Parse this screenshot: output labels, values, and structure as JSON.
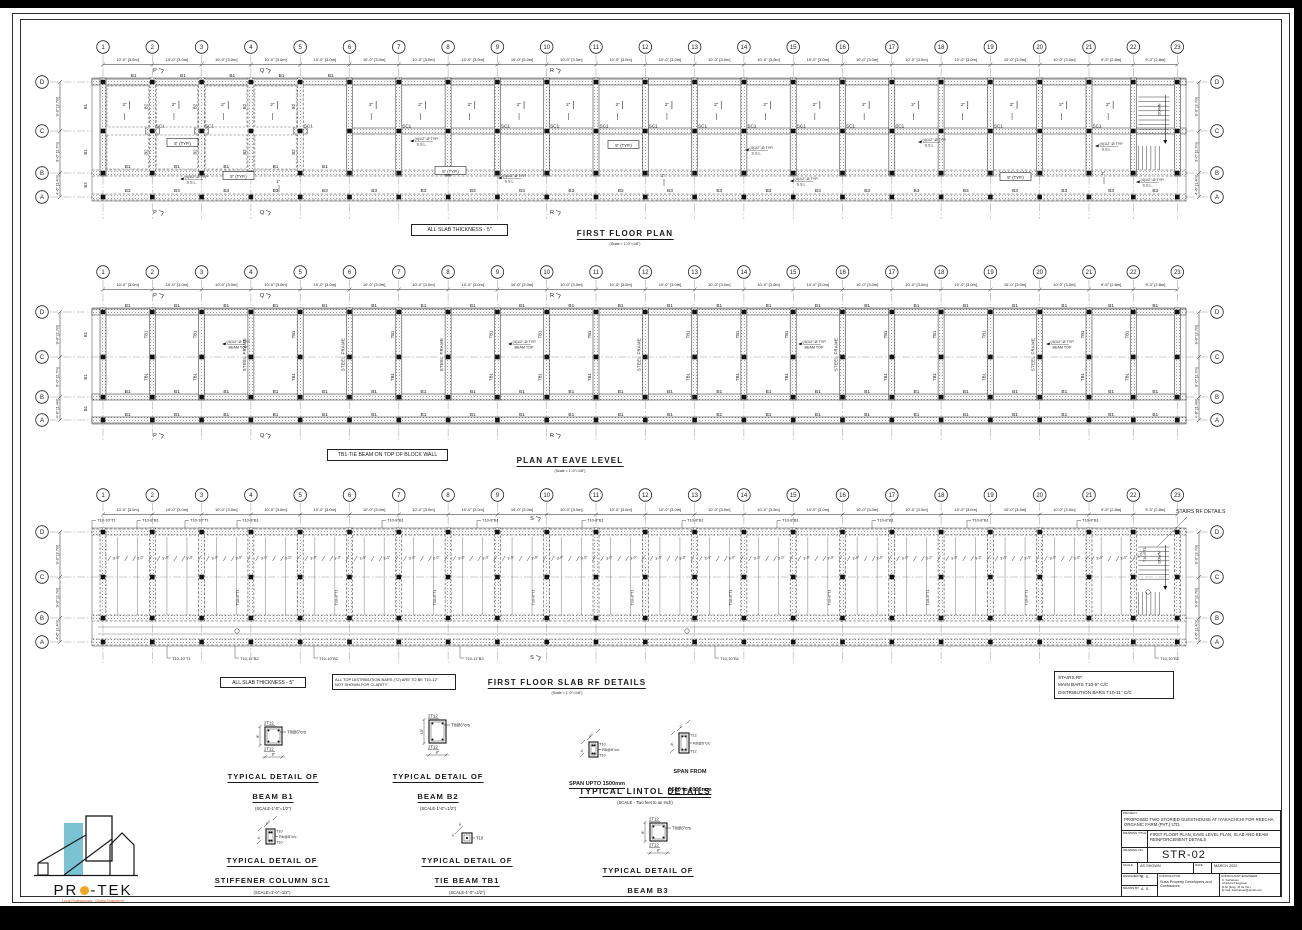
{
  "grid": {
    "numbers": [
      "1",
      "2",
      "3",
      "4",
      "5",
      "6",
      "7",
      "8",
      "9",
      "10",
      "11",
      "12",
      "13",
      "14",
      "15",
      "16",
      "17",
      "18",
      "19",
      "20",
      "21",
      "22",
      "23"
    ],
    "span_dims": [
      "10'-0\" [3.0m]",
      "10'-0\" [3.0m]",
      "10'-0\" [3.0m]",
      "10'-0\" [3.0m]",
      "10'-0\" [3.0m]",
      "10'-0\" [3.0m]",
      "10'-0\" [3.0m]",
      "10'-0\" [3.0m]",
      "10'-0\" [3.0m]",
      "10'-0\" [3.0m]",
      "10'-0\" [3.0m]",
      "10'-0\" [3.0m]",
      "10'-0\" [3.0m]",
      "10'-0\" [3.0m]",
      "10'-0\" [3.0m]",
      "10'-0\" [3.0m]",
      "10'-0\" [3.0m]",
      "10'-0\" [3.0m]",
      "10'-0\" [3.0m]",
      "10'-0\" [3.0m]",
      "9'-5\" [2.8m]",
      "9'-3\" [2.8m]"
    ],
    "rows": [
      "D",
      "C",
      "B",
      "A"
    ],
    "row_dims": [
      "9'-0\" [2.7m]",
      "9'-0\" [2.7m]",
      "4'-6\" [1.4m]"
    ]
  },
  "plan1": {
    "title": "FIRST FLOOR PLAN",
    "scale": "(Scale = 1'-0\"=1/8\")",
    "note": "ALL SLAB THICKNESS - 5\"",
    "beam": "B1",
    "beam_b2": "B2",
    "beam_bottom": "B3",
    "sc1": "SC1",
    "two": "2\"",
    "typ": "5\" (TYP.)",
    "typ_points": [
      [
        167,
        144
      ],
      [
        223,
        177
      ],
      [
        435,
        172
      ],
      [
        608,
        146
      ],
      [
        1000,
        178
      ]
    ],
    "ssl": [
      "(4)1/2\"-Ø TYP.",
      "S.S.L."
    ],
    "ssl_points": [
      [
        180,
        177
      ],
      [
        410,
        139
      ],
      [
        498,
        176
      ],
      [
        745,
        148
      ],
      [
        790,
        179
      ],
      [
        918,
        140
      ],
      [
        1095,
        144
      ],
      [
        1136,
        180
      ]
    ],
    "one": "1\"",
    "one_points": [
      [
        278,
        183
      ],
      [
        663,
        177
      ],
      [
        1103,
        175
      ]
    ],
    "sections": [
      {
        "label": "P",
        "x": 155
      },
      {
        "label": "Q",
        "x": 262
      },
      {
        "label": "R",
        "x": 552
      }
    ],
    "top_spans": [
      0,
      1,
      2,
      3,
      4
    ],
    "sc1_grids": [
      2,
      3,
      5,
      7,
      9,
      10,
      11,
      12,
      13,
      14,
      15,
      16,
      17,
      19,
      21
    ]
  },
  "plan2": {
    "title": "PLAN AT EAVE LEVEL",
    "scale": "(Scale = 1'-0\"=1/8\")",
    "note": "TB1-TIE BEAM ON TOP OF BLOCK WALL",
    "beam": "B1",
    "tb1": "TB1",
    "steel": "STEEL FRAME",
    "note_arrow": [
      "(4)1/2\"-Ø TYP.",
      "BEAM TOP"
    ],
    "note_points": [
      [
        222,
        342
      ],
      [
        508,
        342
      ],
      [
        798,
        342
      ],
      [
        1046,
        342
      ]
    ],
    "tb1_grids": [
      2,
      3,
      5,
      7,
      9,
      10,
      11,
      13,
      14,
      15,
      17,
      18,
      19,
      21,
      22
    ],
    "steel_grids": [
      4,
      6,
      8,
      12,
      16,
      20
    ]
  },
  "plan3": {
    "title": "FIRST FLOOR SLAB RF DETAILS",
    "scale": "(Scale = 1'-0\"=1/8\")",
    "note1": "ALL SLAB THICKNESS - 5\"",
    "note2a": "ALL TOP DISTRIBUTION BARS (T2) ARE TO BE T10-12\"",
    "note2b": "NOT SHOWN FOR CLARITY",
    "stairs_rf": [
      "STAIRS RF:",
      "MAIN BARS   T10-5\" C/C",
      "DISTRIBUTION BARS   T10-11\" C/C"
    ],
    "stairs_label": "STAIRS RF DETAILS",
    "top_callouts": [
      {
        "x": 95,
        "t": "T10-10\"T1"
      },
      {
        "x": 140,
        "t": "T10-8\"B1"
      },
      {
        "x": 188,
        "t": "T10-10\"T1"
      },
      {
        "x": 240,
        "t": "T10-8\"B1"
      },
      {
        "x": 385,
        "t": "T10-8\"B1"
      },
      {
        "x": 480,
        "t": "T10-8\"B1"
      },
      {
        "x": 585,
        "t": "T10-8\"B1"
      },
      {
        "x": 685,
        "t": "T10-8\"B1"
      },
      {
        "x": 780,
        "t": "T10-8\"B1"
      },
      {
        "x": 875,
        "t": "T10-8\"B1"
      },
      {
        "x": 970,
        "t": "T10-8\"B1"
      },
      {
        "x": 1080,
        "t": "T10-8\"B1"
      }
    ],
    "bottom_callouts": [
      {
        "x": 170,
        "t": "T10-10\"T1"
      },
      {
        "x": 238,
        "t": "T10-11\"B2"
      },
      {
        "x": 317,
        "t": "T10-10\"B2"
      },
      {
        "x": 463,
        "t": "T10-11\"B2"
      },
      {
        "x": 718,
        "t": "T10-10\"B1"
      },
      {
        "x": 1158,
        "t": "T10-10\"B2"
      }
    ],
    "vert": "T10-8\"T1",
    "vert_grids": [
      4,
      6,
      8,
      10,
      12,
      14,
      16,
      18,
      20
    ],
    "dim3": "3'-0\"",
    "stair_dim": "4'-5\"",
    "stair_bar": "T10-6\"T1",
    "section": "S"
  },
  "misc": {
    "down": "DOWN"
  },
  "details": {
    "b1": {
      "t1": "TYPICAL DETAIL OF",
      "t2": "BEAM B1",
      "scale": "(SCALE-1'-0\"=1/2\")",
      "top": "2T12",
      "bot": "2T12",
      "stir": "T8@6\"crs",
      "w": "8\"",
      "h": "8\""
    },
    "b2": {
      "t1": "TYPICAL DETAIL OF",
      "t2": "BEAM B2",
      "scale": "(SCALE-1'-0\"=1/2\")",
      "top": "2T12",
      "bot": "2T12",
      "stir": "T8@6\"crs",
      "w": "8\"",
      "h": "10\""
    },
    "b3": {
      "t1": "TYPICAL DETAIL OF",
      "t2": "BEAM B3",
      "top": "2T12",
      "bot": "2T12",
      "stir": "T8@6\"crs",
      "w": "8\"",
      "h": "8\""
    },
    "lintol": {
      "title": "TYPICAL LINTOL DETAILS",
      "scale": "(SCALE - Two feet to an Inch)",
      "left": {
        "span": "SPAN UPTO 1500mm",
        "top": "T10",
        "bot": "T10",
        "stir": "R6@5\"c/c",
        "w": "4½\"",
        "h": "6\""
      },
      "right": {
        "span1": "SPAN FROM",
        "span2": "1500 to 2000mm",
        "top": "T12",
        "bot": "T12",
        "stir": "R6@5\"c/c",
        "w": "6\"",
        "h": "9\""
      }
    },
    "sc1": {
      "t1": "TYPICAL DETAIL OF",
      "t2": "STIFFENER COLUMN SC1",
      "scale": "(SCALE=1'-0\"=1/2\")",
      "top": "T10",
      "bot": "T10",
      "stir": "R6@5\"c/c",
      "w": "4½\"",
      "h": "6\""
    },
    "tb1": {
      "t1": "TYPICAL DETAIL OF",
      "t2": "TIE BEAM TB1",
      "scale": "(SCALE-1'-0\"=1/2\")",
      "bar": "T10",
      "w": "4\"",
      "h": "4\""
    }
  },
  "logo": {
    "pre": "PR",
    "post": "-TEK",
    "tagline": "Local Professionals · Global Experience",
    "accent_cyan": "#7ac3d3",
    "accent_orange": "#f2a51d"
  },
  "titleblock": {
    "project_label": "PROJECT:",
    "project": "PROPOSED TWO STORIED GUESTHOUSE AT IYAKACHCHI FOR REECHA ORGANIC FARM (PVT.) LTD.",
    "title_label": "DRAWING TITLE",
    "title": "FIRST FLOOR PLAN, EAVE LEVEL PLAN, SLAB AND BEAM REINFORCEMENT DETAILS",
    "no_label": "DRAWING NO.",
    "no": "STR-02",
    "scale_label": "SCALE",
    "scale": "AS SHOWN",
    "date_label": "DATE",
    "date": "MARCH 2022",
    "designed_label": "DESIGNED BY",
    "designed": "K. S.",
    "drawn_label": "DRAWN BY",
    "drawn": "A. S.",
    "contractor_label": "CONTRACTOR:",
    "contractor": "Susa Property Developers and Contractors",
    "engineer_label": "CONSULTANT ENGINEER:",
    "engineer": [
      "K. Sutharsan",
      "Chartered Engineer",
      "B.Sc (Eng), M.I.E (SL)",
      "E-mail: ksutharsan@gmail.com"
    ]
  }
}
